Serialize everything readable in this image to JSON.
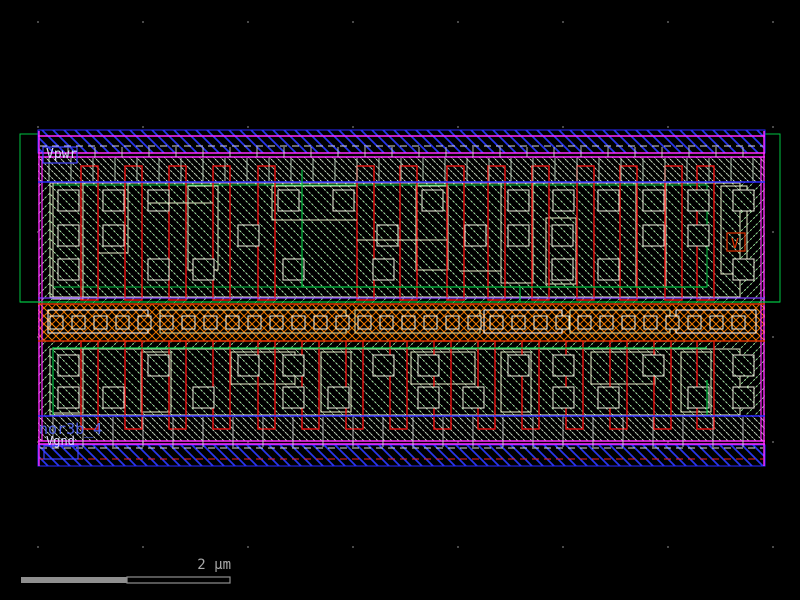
{
  "labels": {
    "vpwr": "Vpwr",
    "vgnd": "Vgnd",
    "cell_name": "nor3b_4",
    "via_marker": "V",
    "scale": "2 µm"
  },
  "colors": {
    "magenta": "#ff2bff",
    "rail_blue": "#2a2aff",
    "poly_red": "#ee1010",
    "band_red": "#d83000",
    "green": "#00c342",
    "violet": "#7d3cff",
    "cream": "#e8ecc8",
    "white": "#e8e8e8",
    "port_blue": "#4242ff",
    "text_gray": "#a8a8a8",
    "label_blue": "#5063e8",
    "dot_gray": "#707070"
  },
  "grid": {
    "xs": [
      38,
      143,
      248,
      353,
      458,
      563,
      668,
      773
    ],
    "ys": [
      22,
      127,
      232,
      337,
      442,
      547
    ],
    "dot_size": 1.6
  },
  "layout": {
    "rects": [
      [
        "nwell-outline",
        20,
        134,
        760,
        168,
        "#00c342",
        "none",
        1
      ],
      [
        "cell-body-hatch",
        38,
        157,
        727,
        284,
        "none",
        "hatchCellA",
        0
      ],
      [
        "metal1-rail-top",
        38,
        130,
        727,
        23,
        "#2a2aff",
        "hatchBlue",
        1
      ],
      [
        "metal1-rail-bottom",
        38,
        445,
        727,
        21,
        "#2a2aff",
        "hatchBlue",
        1
      ],
      [
        "li-band-top",
        38,
        157,
        727,
        25,
        "none",
        "hatchLi",
        0
      ],
      [
        "li-band-bottom",
        38,
        415,
        727,
        26,
        "none",
        "hatchLi",
        0
      ],
      [
        "pdiff-region",
        50,
        183,
        690,
        114,
        "#e8ecc8",
        "hatchCellB",
        1
      ],
      [
        "ndiff-region",
        50,
        349,
        690,
        66,
        "#e8ecc8",
        "hatchCellB",
        1
      ],
      [
        "tap-band",
        38,
        304,
        727,
        37,
        "none",
        "hatchOrange",
        0
      ],
      [
        "nwell-inner-outline",
        53,
        185,
        654,
        102,
        "#00c342",
        "none",
        1
      ],
      [
        "tap-box-1",
        48,
        310,
        100,
        23,
        "#ffffff",
        "none",
        1
      ],
      [
        "tap-box-2",
        160,
        310,
        186,
        23,
        "#e8e0a0",
        "none",
        1
      ],
      [
        "tap-box-3",
        355,
        310,
        125,
        23,
        "#e8e0a0",
        "none",
        1
      ],
      [
        "tap-box-4",
        484,
        310,
        78,
        23,
        "#ffffff",
        "none",
        1
      ],
      [
        "tap-box-5",
        570,
        310,
        100,
        23,
        "#e8e0a0",
        "none",
        1
      ],
      [
        "tap-box-6",
        676,
        310,
        80,
        23,
        "#ffffff",
        "none",
        1
      ],
      [
        "li-shape",
        53,
        183,
        30,
        116,
        "#e8ecc8",
        "none",
        1
      ],
      [
        "li-shape",
        98,
        183,
        30,
        70,
        "#e8ecc8",
        "none",
        1
      ],
      [
        "li-shape",
        188,
        186,
        30,
        84,
        "#e8ecc8",
        "none",
        1
      ],
      [
        "li-shape",
        272,
        186,
        85,
        34,
        "#e8ecc8",
        "none",
        1
      ],
      [
        "li-shape",
        416,
        186,
        32,
        84,
        "#e8ecc8",
        "none",
        1
      ],
      [
        "li-shape",
        501,
        183,
        32,
        100,
        "#e8ecc8",
        "none",
        1
      ],
      [
        "li-shape",
        546,
        218,
        30,
        66,
        "#e8ecc8",
        "none",
        1
      ],
      [
        "li-shape",
        636,
        183,
        30,
        104,
        "#e8ecc8",
        "none",
        1
      ],
      [
        "li-shape",
        721,
        186,
        26,
        88,
        "#e8ecc8",
        "none",
        1
      ],
      [
        "li-shape",
        53,
        349,
        30,
        64,
        "#e8ecc8",
        "none",
        1
      ],
      [
        "li-shape",
        141,
        352,
        30,
        60,
        "#e8ecc8",
        "none",
        1
      ],
      [
        "li-shape",
        231,
        352,
        64,
        32,
        "#e8ecc8",
        "none",
        1
      ],
      [
        "li-shape",
        321,
        352,
        30,
        60,
        "#e8ecc8",
        "none",
        1
      ],
      [
        "li-shape",
        411,
        352,
        64,
        32,
        "#e8ecc8",
        "none",
        1
      ],
      [
        "li-shape",
        501,
        352,
        30,
        60,
        "#e8ecc8",
        "none",
        1
      ],
      [
        "li-shape",
        591,
        352,
        64,
        32,
        "#e8ecc8",
        "none",
        1
      ],
      [
        "li-shape",
        681,
        352,
        30,
        60,
        "#e8ecc8",
        "none",
        1
      ]
    ],
    "gates": {
      "upper": {
        "y": 166,
        "h": 134,
        "w": 17,
        "xs": [
          81,
          125,
          169,
          213,
          258,
          357,
          400,
          447,
          488,
          532,
          577,
          620,
          665,
          697
        ]
      },
      "lower": {
        "y": 341,
        "h": 88,
        "w": 17,
        "xs": [
          81,
          125,
          169,
          213,
          258,
          302,
          346,
          390,
          434,
          478,
          522,
          566,
          610,
          654,
          697
        ]
      }
    },
    "contact_rows": [
      {
        "y": 190,
        "size": 21,
        "xs": [
          58,
          103,
          148,
          278,
          333,
          422,
          508,
          553,
          598,
          643,
          688,
          733
        ]
      },
      {
        "y": 225,
        "size": 21,
        "xs": [
          58,
          103,
          238,
          377,
          465,
          508,
          552,
          643,
          688
        ]
      },
      {
        "y": 259,
        "size": 21,
        "xs": [
          58,
          148,
          193,
          283,
          373,
          552,
          598,
          733
        ]
      },
      {
        "y": 355,
        "size": 21,
        "xs": [
          58,
          148,
          238,
          283,
          373,
          418,
          508,
          553,
          643,
          733
        ]
      },
      {
        "y": 387,
        "size": 21,
        "xs": [
          58,
          103,
          193,
          283,
          328,
          418,
          463,
          553,
          598,
          688,
          733
        ]
      }
    ],
    "mid_contacts": {
      "y": 316,
      "size": 13,
      "x_start": 50,
      "x_step": 22,
      "count": 32
    },
    "lines": [
      [
        "cell-top-magenta",
        38,
        136,
        765,
        136,
        "#ff2bff",
        1.4,
        ""
      ],
      [
        "cell-top-magenta",
        38,
        153,
        765,
        153,
        "#ff2bff",
        1.6,
        ""
      ],
      [
        "cell-top-magenta",
        38,
        157,
        765,
        157,
        "#ff2bff",
        1.4,
        ""
      ],
      [
        "cell-bottom-magenta",
        38,
        441,
        765,
        441,
        "#ff2bff",
        1.6,
        ""
      ],
      [
        "cell-bottom-magenta",
        38,
        444,
        765,
        444,
        "#ff2bff",
        1.4,
        ""
      ],
      [
        "cell-left-magenta",
        39,
        131,
        39,
        466,
        "#ff2bff",
        1.4,
        ""
      ],
      [
        "cell-left-magenta",
        42,
        157,
        42,
        441,
        "#ff2bff",
        1.2,
        ""
      ],
      [
        "cell-right-magenta",
        761,
        157,
        761,
        441,
        "#ff2bff",
        1.2,
        ""
      ],
      [
        "cell-right-magenta",
        764,
        131,
        764,
        466,
        "#ff2bff",
        1.4,
        ""
      ],
      [
        "li-dashed-top",
        40,
        146,
        763,
        146,
        "#d8d8d8",
        1,
        "7,5"
      ],
      [
        "li-dashed-bottom",
        40,
        448,
        763,
        448,
        "#d8d8d8",
        1,
        "7,5"
      ],
      [
        "red-dashed-bottom",
        40,
        459,
        763,
        459,
        "#ee2222",
        1,
        "7,5"
      ],
      [
        "met-blue-upper",
        38,
        182,
        765,
        182,
        "#2a2aff",
        1.4,
        ""
      ],
      [
        "met-blue-lower",
        38,
        416,
        765,
        416,
        "#2a2aff",
        1.4,
        ""
      ],
      [
        "violet-line",
        38,
        298,
        765,
        298,
        "#7d3cff",
        1.2,
        ""
      ],
      [
        "nwell-bottom-green",
        20,
        302,
        780,
        302,
        "#00c342",
        1.2,
        ""
      ],
      [
        "nwell-step-green",
        302,
        287,
        707,
        287,
        "#00c342",
        1.2,
        ""
      ],
      [
        "nwell-step-green",
        302,
        170,
        302,
        287,
        "#00c342",
        1.2,
        ""
      ],
      [
        "nwell-step-green",
        520,
        287,
        520,
        302,
        "#00c342",
        1.2,
        ""
      ],
      [
        "psub-green",
        53,
        348,
        707,
        348,
        "#00c342",
        1.2,
        ""
      ],
      [
        "psub-green",
        53,
        347,
        53,
        415,
        "#00c342",
        1.2,
        ""
      ],
      [
        "psub-green",
        707,
        380,
        707,
        415,
        "#00c342",
        1.2,
        ""
      ],
      [
        "tap-band-red",
        38,
        304,
        765,
        304,
        "#d83000",
        1.4,
        ""
      ],
      [
        "tap-band-red",
        38,
        341,
        765,
        341,
        "#d83000",
        1.4,
        ""
      ],
      [
        "li-step",
        148,
        203,
        213,
        203,
        "#e8ecc8",
        1,
        ""
      ],
      [
        "li-step",
        272,
        220,
        357,
        220,
        "#e8ecc8",
        1,
        ""
      ],
      [
        "li-step",
        357,
        240,
        447,
        240,
        "#e8ecc8",
        1,
        ""
      ],
      [
        "li-step",
        460,
        271,
        501,
        271,
        "#e8ecc8",
        1,
        ""
      ]
    ],
    "tick_groups": [
      {
        "name": "rail-top-ticks",
        "y1": 147,
        "y2": 157,
        "x_start": 68,
        "x_step": 27,
        "count": 26,
        "color": "#cfcfcf"
      },
      {
        "name": "li-top-ticks",
        "y1": 158,
        "y2": 181,
        "x_start": 49,
        "x_step": 22,
        "count": 33,
        "color": "#c9dcc9"
      },
      {
        "name": "li-bottom-ticks",
        "y1": 417,
        "y2": 447,
        "x_start": 53,
        "x_step": 30,
        "count": 24,
        "color": "#cfcfcf"
      }
    ],
    "boxes": [
      [
        "vpwr-port-box",
        43,
        147,
        34,
        16,
        "#4242ff"
      ],
      [
        "vgnd-port-box",
        44,
        446,
        34,
        13,
        "#4242ff"
      ],
      [
        "via-marker-box",
        727,
        233,
        18,
        18,
        "#e03000"
      ]
    ]
  },
  "scalebar": {
    "filled": {
      "x": 21,
      "y": 577,
      "w": 106,
      "h": 6
    },
    "outline": {
      "x": 127,
      "y": 577,
      "w": 103,
      "h": 6
    },
    "color": "#8f8f8f"
  }
}
